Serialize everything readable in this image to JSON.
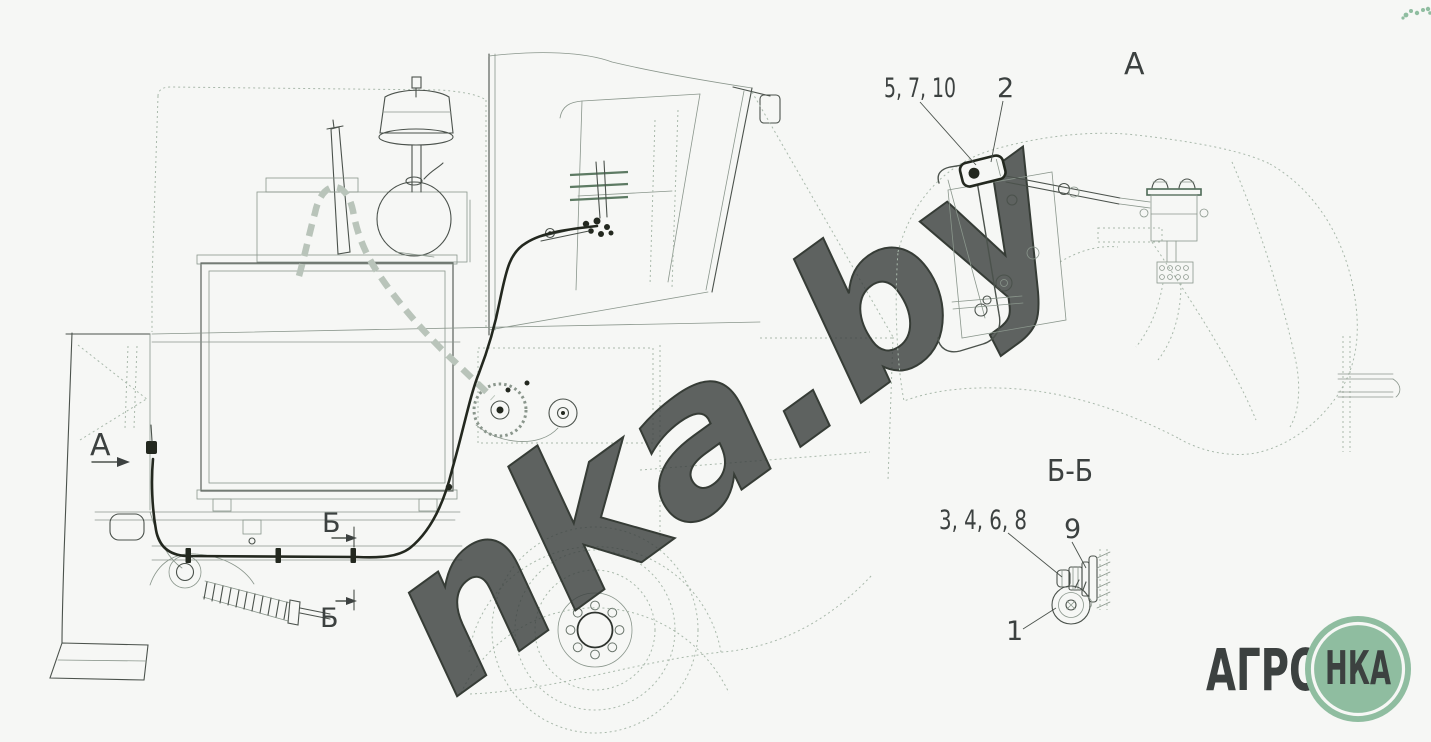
{
  "colors": {
    "background": "#f6f7f5",
    "line": "#4b524c",
    "line_light": "#a9b9ab",
    "cable": "#23281f",
    "hose_highlight": "#b9c4ba",
    "brand_green": "#8fbda0",
    "text": "#3c4140"
  },
  "main_view": {
    "view_arrow_label": "А",
    "section_markers": [
      {
        "label": "Б"
      },
      {
        "label": "Б"
      }
    ]
  },
  "detail_view_a": {
    "title": "А",
    "callouts": [
      {
        "label": "5, 7, 10"
      },
      {
        "label": "2"
      }
    ]
  },
  "section_view_bb": {
    "title": "Б-Б",
    "callouts": [
      {
        "label": "3, 4, 6, 8"
      },
      {
        "label": "9"
      },
      {
        "label": "1"
      }
    ]
  },
  "watermark": {
    "text": "nka.by"
  },
  "logo": {
    "wordmark": "АГРО",
    "badge": "НКА"
  }
}
